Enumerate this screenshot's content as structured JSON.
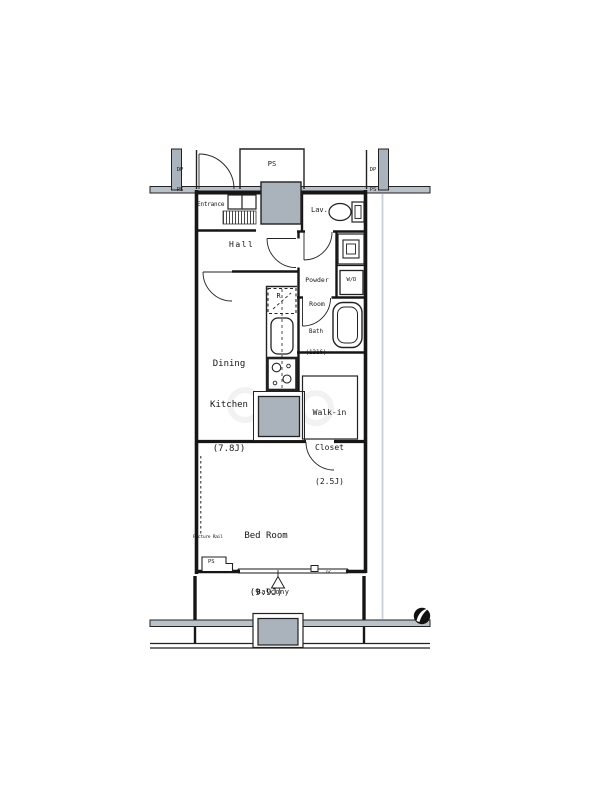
{
  "title": "Apartment floor plan",
  "colors": {
    "wall": "#161616",
    "shaft_fill": "#aab3bb",
    "rail_fill": "#bac2c9",
    "background": "#ffffff"
  },
  "rooms": {
    "entrance": {
      "label": "Entrance"
    },
    "hall": {
      "label": "Hall"
    },
    "lavatory": {
      "label": "Lav."
    },
    "powder_room": {
      "lines": [
        "Powder",
        "Room"
      ]
    },
    "bath": {
      "lines": [
        "Bath",
        "(1216)"
      ]
    },
    "dining_kitchen": {
      "lines": [
        "Dining",
        "Kitchen",
        "(7.8J)"
      ]
    },
    "walk_in_closet": {
      "lines": [
        "Walk-in",
        "Closet",
        "(2.5J)"
      ]
    },
    "bed_room": {
      "lines": [
        "Bed Room",
        "(9.9J)"
      ]
    },
    "balcony": {
      "label": "Balcony"
    }
  },
  "utilities": {
    "pipe_space_top": "PS",
    "dp_ps_left": [
      "DP",
      "PS"
    ],
    "dp_ps_right": [
      "DP",
      "PS"
    ],
    "washer_dryer": "W/D",
    "refrigerator": "R",
    "pipe_space_bottom": "PS",
    "picture_rail": "Picture Rail",
    "small_mark_right": "nc"
  }
}
